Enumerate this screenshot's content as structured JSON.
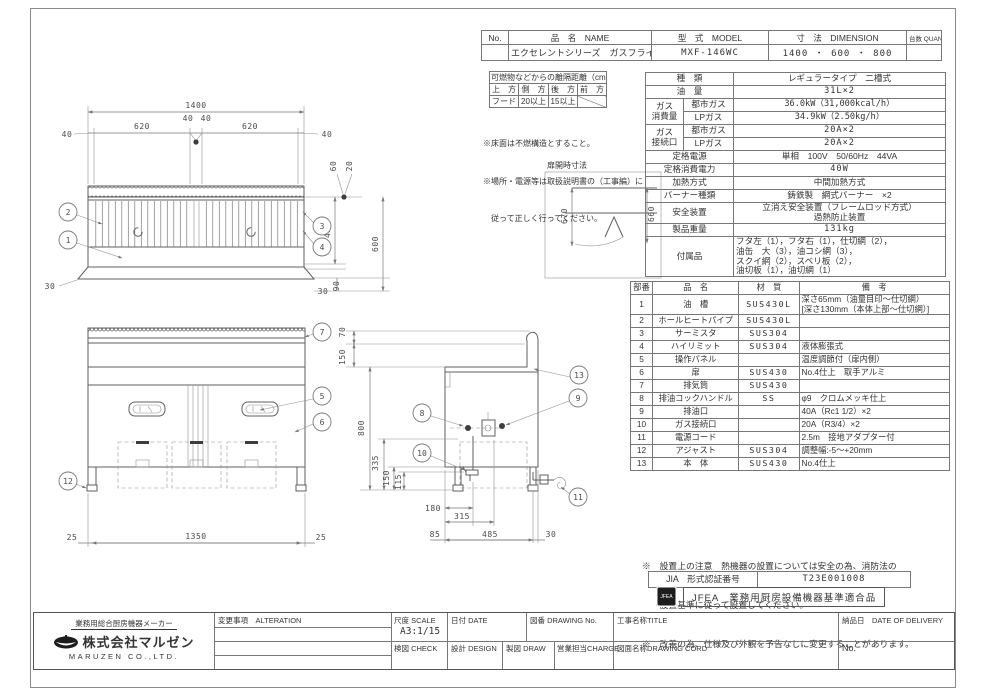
{
  "colors": {
    "line": "#5f5f5f",
    "border": "#777777",
    "text": "#333333",
    "background": "#ffffff"
  },
  "header": {
    "col_no": "No.",
    "col_name": "品　名　NAME",
    "col_model": "型　式　MODEL",
    "col_dim": "寸　法　DIMENSION",
    "col_qty": "台数 QUANTITY",
    "no": "",
    "name": "エクセレントシリーズ　ガスフライヤー",
    "model": "MXF-146WC",
    "dimension": "1400 ・ 600 ・ 800",
    "quantity": ""
  },
  "clearance": {
    "title": "可燃物などからの離隔距離（cm）",
    "h_top": "上　方",
    "h_side": "側　方",
    "h_rear": "後　方",
    "h_front": "前　方",
    "v_top": "フード",
    "v_side": "20以上",
    "v_rear": "15以上",
    "v_front": "",
    "note1": "※床面は不燃構造とすること。",
    "note2": "※場所・電源等は取扱説明書の（工事編）に",
    "note3": "　従って正しく行ってください。"
  },
  "spec": {
    "type": {
      "label": "種　類",
      "value": "レギュラータイプ　二槽式"
    },
    "oil": {
      "label": "油　量",
      "value": "31L×2"
    },
    "gas_consumption": {
      "label": "ガス\n消費量",
      "sub1": "都市ガス",
      "val1": "36.0kW（31,000kcal/h）",
      "sub2": "LPガス",
      "val2": "34.9kW（2.50kg/h）"
    },
    "gas_connection": {
      "label": "ガス\n接続口",
      "sub1": "都市ガス",
      "val1": "20A×2",
      "sub2": "LPガス",
      "val2": "20A×2"
    },
    "power": {
      "label": "定格電源",
      "value": "単相　100V　50/60Hz　44VA"
    },
    "power_consumption": {
      "label": "定格消費電力",
      "value": "40W"
    },
    "heating": {
      "label": "加熱方式",
      "value": "中間加熱方式"
    },
    "burner": {
      "label": "バーナー種類",
      "value": "鋳鉄製　網式バーナー　×2"
    },
    "safety": {
      "label": "安全装置",
      "value": "立消え安全装置（フレームロッド方式）\n過熱防止装置"
    },
    "weight": {
      "label": "製品重量",
      "value": "131kg"
    },
    "accessories": {
      "label": "付属品",
      "value": "フタ左（1），フタ右（1），仕切網（2），\n油缶　大（3），油コシ網（3），\nスクイ網（2），スベリ板（2），\n油切板（1），油切網（1）"
    }
  },
  "parts": {
    "h_no": "部番",
    "h_name": "品　名",
    "h_mat": "材　質",
    "h_note": "備　考",
    "rows": [
      {
        "no": "1",
        "name": "油　槽",
        "mat": "SUS430L",
        "note": "深さ65mm（油量目印～仕切網）\n[深さ130mm（本体上部～仕切網）]"
      },
      {
        "no": "2",
        "name": "ホールヒートパイプ",
        "mat": "SUS430L",
        "note": ""
      },
      {
        "no": "3",
        "name": "サーミスタ",
        "mat": "SUS304",
        "note": ""
      },
      {
        "no": "4",
        "name": "ハイリミット",
        "mat": "SUS304",
        "note": "液体膨張式"
      },
      {
        "no": "5",
        "name": "操作パネル",
        "mat": "",
        "note": "温度調節付（扉内側）"
      },
      {
        "no": "6",
        "name": "扉",
        "mat": "SUS430",
        "note": "No.4仕上　取手アルミ"
      },
      {
        "no": "7",
        "name": "排気筒",
        "mat": "SUS430",
        "note": ""
      },
      {
        "no": "8",
        "name": "排油コックハンドル",
        "mat": "SS",
        "note": "φ9　クロムメッキ仕上"
      },
      {
        "no": "9",
        "name": "排油口",
        "mat": "",
        "note": "40A（Rc1 1/2）×2"
      },
      {
        "no": "10",
        "name": "ガス接続口",
        "mat": "",
        "note": "20A（R3/4）×2"
      },
      {
        "no": "11",
        "name": "電源コード",
        "mat": "",
        "note": "2.5m　接地アダプター付"
      },
      {
        "no": "12",
        "name": "アジャスト",
        "mat": "SUS304",
        "note": "調整幅:-5～+20mm"
      },
      {
        "no": "13",
        "name": "本　体",
        "mat": "SUS430",
        "note": "No.4仕上"
      }
    ]
  },
  "site_notes": {
    "line1": "※　設置上の注意　熱機器の設置については安全の為、消防法の",
    "line2": "　　設置基準に従って設置してください。",
    "line3": "※　改善の為、仕様及び外観を予告なしに変更することがあります。"
  },
  "jia": {
    "label": "JIA　形式認証番号",
    "value": "T23E001008"
  },
  "jfea": {
    "stamp": "JFEA",
    "text": "JFEA　業務用厨房設備機器基準適合品"
  },
  "titleblock": {
    "maker_tagline": "業務用総合厨房機器メーカー",
    "company": "株式会社マルゼン",
    "company_en": "MARUZEN CO.,LTD.",
    "alteration": "変更事項　ALTERATION",
    "scale_label": "尺度 SCALE",
    "scale_value": "A3:1/15",
    "date_label": "日付 DATE",
    "check_label": "検図 CHECK",
    "design_label": "設計 DESIGN",
    "draw_label": "製図 DRAW",
    "charge_label": "営業担当CHARGE",
    "drawing_no_label": "図番 DRAWING No.",
    "title_label": "工事名称TITLE",
    "cord_label": "図面名称DRAWING CORD",
    "delivery_label": "納品日　DATE OF DELIVERY",
    "no_label": "No."
  },
  "dims": {
    "plan": {
      "overall": "1400",
      "m40l": "40",
      "t620l": "620",
      "m40c1": "40",
      "m40c2": "40",
      "t620r": "620",
      "m40r": "40",
      "off60": "60",
      "off20": "20",
      "d430": "430",
      "d600": "600",
      "b30l": "30",
      "b30r": "30",
      "b90": "90"
    },
    "front": {
      "l25": "25",
      "w1350": "1350",
      "r25": "25"
    },
    "side": {
      "h70": "70",
      "h150": "150",
      "h800": "800",
      "h335": "335",
      "h150b": "150",
      "h115": "115",
      "d180": "180",
      "d315": "315",
      "d85": "85",
      "d485": "485",
      "d30": "30"
    },
    "door": {
      "title": "扉開時寸法",
      "h670": "670",
      "h660": "660"
    },
    "balloons": {
      "b1": "1",
      "b2": "2",
      "b3": "3",
      "b4": "4",
      "b5": "5",
      "b6": "6",
      "b7": "7",
      "b8": "8",
      "b9": "9",
      "b10": "10",
      "b11": "11",
      "b12": "12",
      "b13": "13"
    }
  }
}
